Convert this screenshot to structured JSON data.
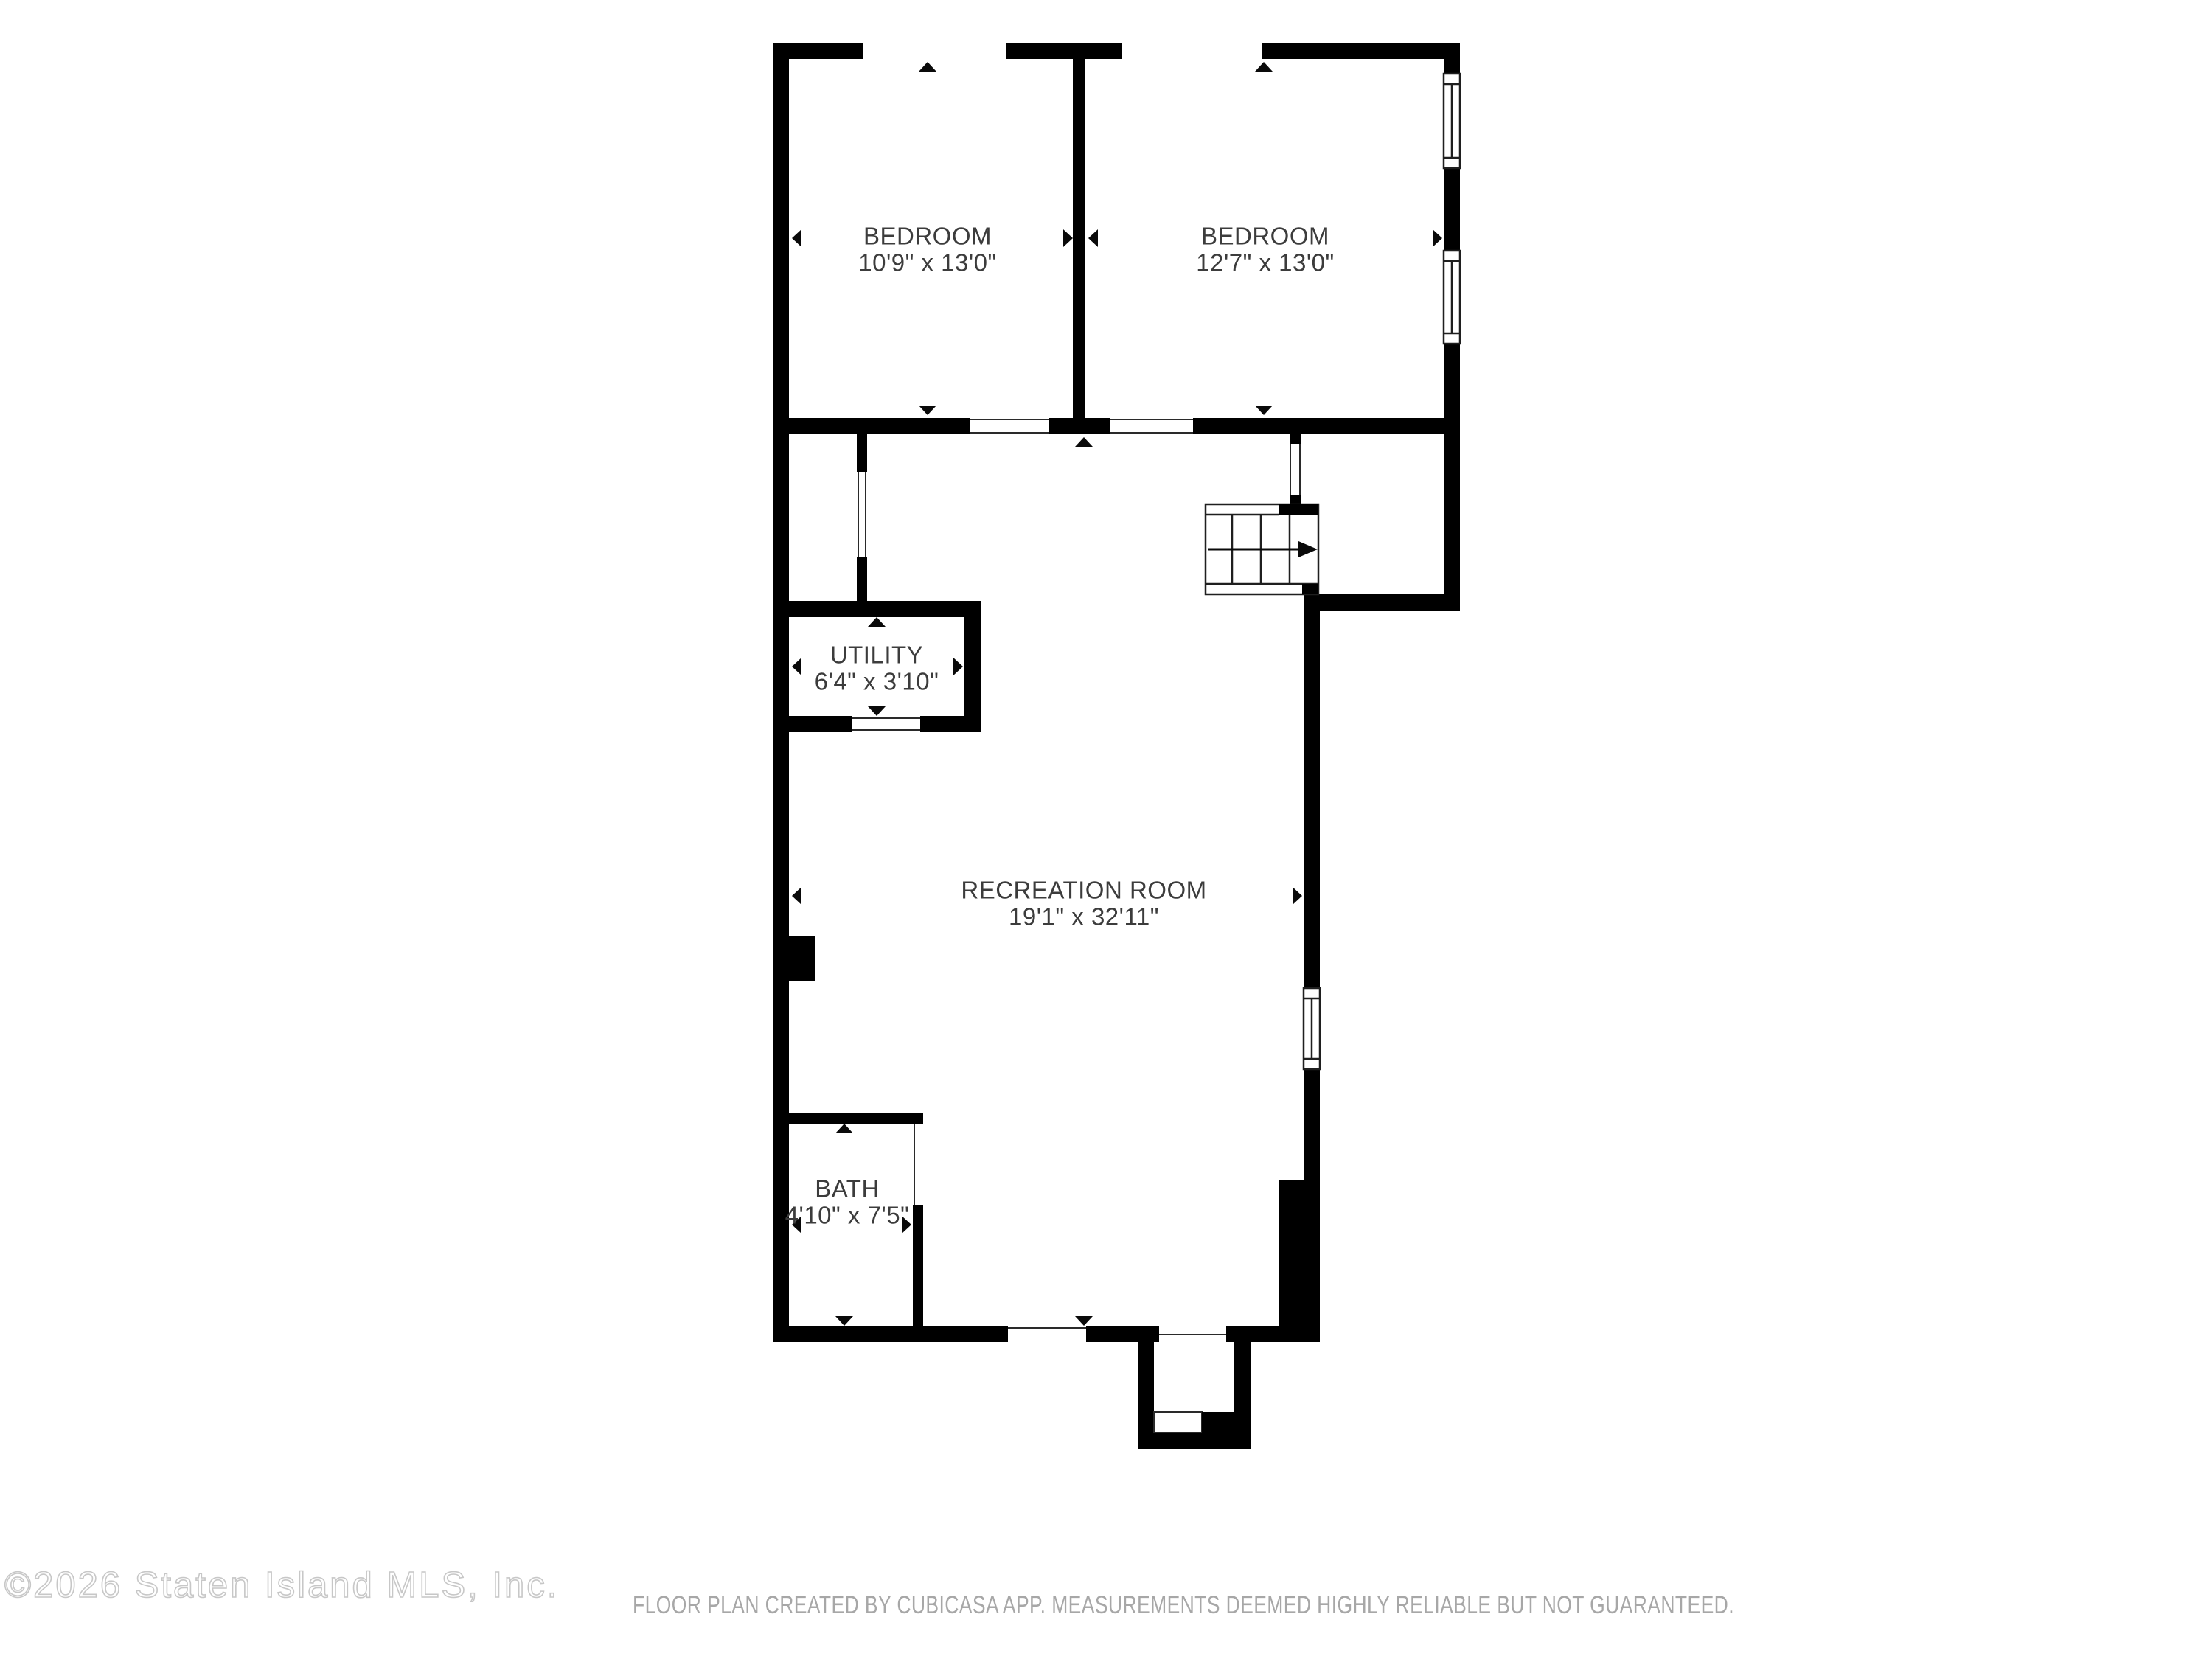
{
  "floor_plan": {
    "rooms": {
      "bedroom1": {
        "name": "BEDROOM",
        "dims": "10'9\" x 13'0\""
      },
      "bedroom2": {
        "name": "BEDROOM",
        "dims": "12'7\" x 13'0\""
      },
      "utility": {
        "name": "UTILITY",
        "dims": "6'4\" x 3'10\""
      },
      "recreation": {
        "name": "RECREATION ROOM",
        "dims": "19'1\" x 32'11\""
      },
      "bath": {
        "name": "BATH",
        "dims": "4'10\" x 7'5\""
      }
    },
    "features": [
      "staircase-with-up-arrow",
      "three-windows",
      "entry-porch-with-step",
      "chimney-block",
      "dimension-arrow-markers"
    ]
  },
  "footer": {
    "copyright": "©2026 Staten Island MLS, Inc.",
    "disclaimer": "FLOOR PLAN CREATED BY CUBICASA APP. MEASUREMENTS DEEMED HIGHLY RELIABLE BUT NOT GUARANTEED."
  },
  "colors": {
    "wall": "#000000",
    "label_text": "#3c3c3c",
    "thin_line": "#1f1f1f",
    "disclaimer_text": "#a7a7a7",
    "copyright_outline": "#c7c7c7",
    "background": "#ffffff"
  }
}
